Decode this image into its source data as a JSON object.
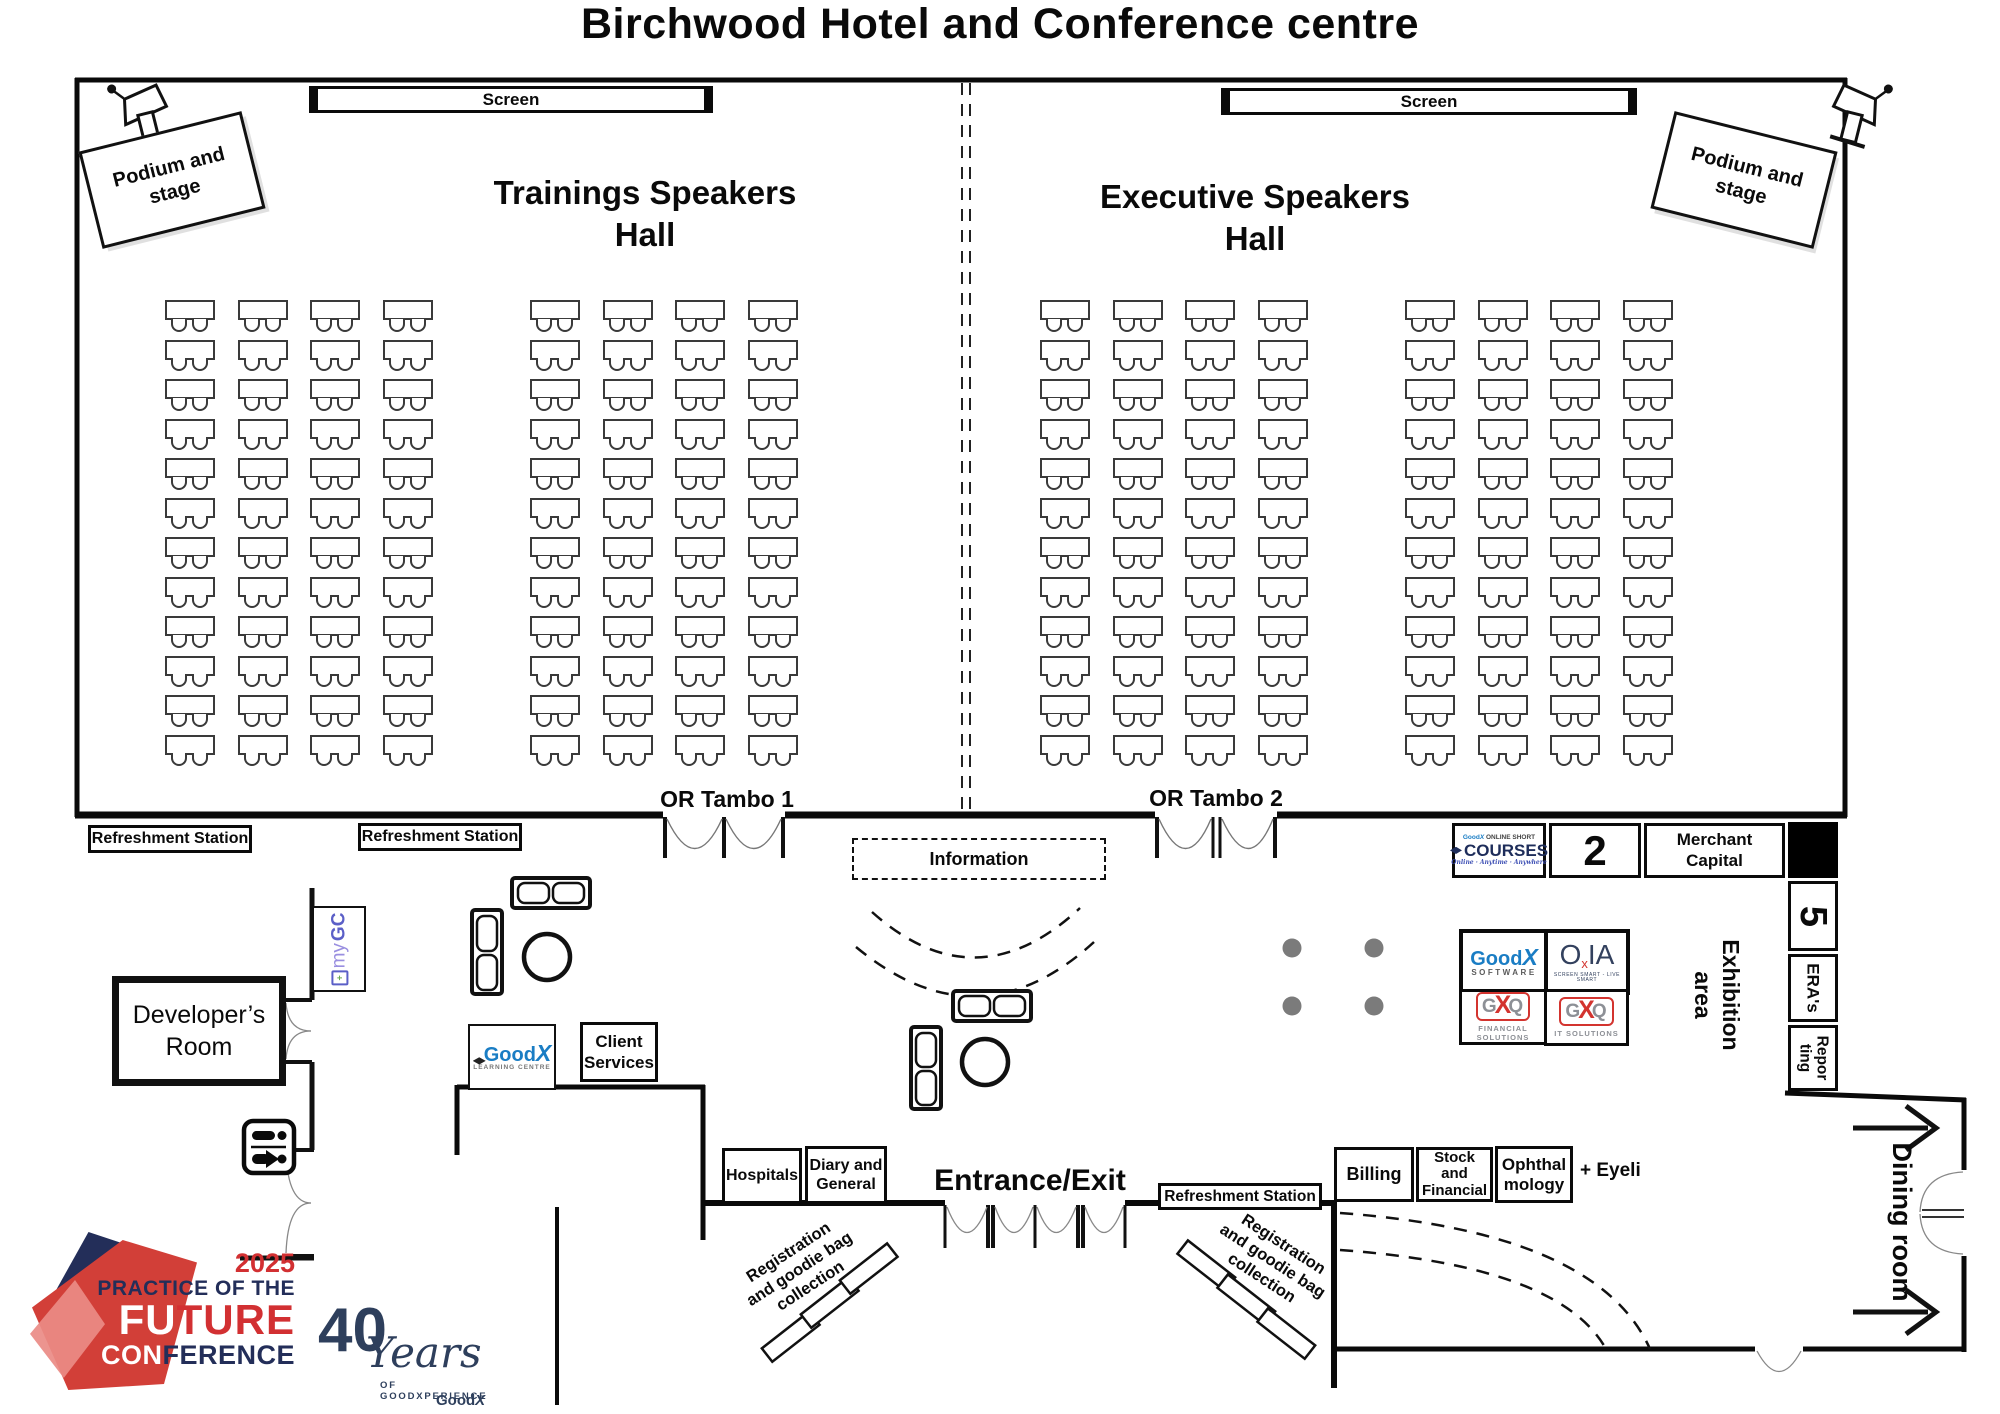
{
  "title": "Birchwood Hotel and Conference centre",
  "halls": {
    "left": {
      "name": "Trainings Speakers\nHall",
      "screen": "Screen",
      "podium": "Podium and\nstage",
      "door": "OR Tambo 1"
    },
    "right": {
      "name": "Executive Speakers\nHall",
      "screen": "Screen",
      "podium": "Podium and\nstage",
      "door": "OR Tambo 2"
    }
  },
  "seating": {
    "rows": 12,
    "cols": 4,
    "col_pitch": 72.5,
    "row_pitch": 39.5,
    "blocks": [
      {
        "x": 165,
        "y": 300
      },
      {
        "x": 530,
        "y": 300
      },
      {
        "x": 1040,
        "y": 300
      },
      {
        "x": 1405,
        "y": 300
      }
    ]
  },
  "concourse": {
    "refreshment_station_a": "Refreshment Station",
    "refreshment_station_b": "Refreshment Station",
    "information": "Information",
    "developers_room": "Developer’s\nRoom",
    "client_services": "Client\nServices",
    "exhibition_area": "Exhibition\narea",
    "mygc": {
      "my": "my",
      "gc": "GC"
    },
    "goodx_learning": {
      "good": "Good",
      "x": "X",
      "sub": "LEARNING CENTRE"
    }
  },
  "stands": {
    "courses": {
      "brand_good": "Good",
      "brand_x": "X",
      "brand_small": "ONLINE SHORT",
      "main": "COURSES",
      "tagline": "Online · Anytime · Anywhere"
    },
    "stand_2": "2",
    "merchant_capital": "Merchant\nCapital",
    "stand_5": "5",
    "eras": "ERA's",
    "reporting": "Repor\nting",
    "goodx_software": {
      "good": "Good",
      "x": "X",
      "sub": "SOFTWARE"
    },
    "oxia": {
      "o": "O",
      "x": "x",
      "ia": "IA",
      "tagline": "SCREEN SMART - LIVE SMART"
    },
    "gxq_financial": {
      "g": "G",
      "x": "X",
      "q": "Q",
      "sub": "FINANCIAL\nSOLUTIONS"
    },
    "gxq_it": {
      "g": "G",
      "x": "X",
      "q": "Q",
      "sub": "IT SOLUTIONS"
    }
  },
  "entrance": {
    "label": "Entrance/Exit",
    "hospitals": "Hospitals",
    "diary_general": "Diary and\nGeneral",
    "billing": "Billing",
    "stock_financial": "Stock\nand\nFinancial",
    "ophthalmology": "Ophthal\nmology",
    "eyeli": "+ Eyeli",
    "registration_left": "Registration\nand goodie bag\ncollection",
    "registration_right": "Registration\nand goodie bag\ncollection",
    "refreshment_station": "Refreshment Station"
  },
  "dining_room": "Dining room",
  "footer": {
    "pof": {
      "year": "2025",
      "line1": "PRACTICE OF THE",
      "fu": "FU",
      "ture": "TURE",
      "con": "CON",
      "ference": "FERENCE"
    },
    "forty": {
      "num": "40",
      "years": "Years",
      "sub": "OF GOODXPERIENCE",
      "brand_good": "Good",
      "brand_x": "X"
    }
  },
  "colors": {
    "wall": "#0a0a0a",
    "seat_stroke": "#3a3a3a",
    "pillar": "#7b7b7b",
    "navy": "#232e59",
    "red": "#d23032",
    "goodx_blue": "#1a7dc4",
    "gxq_red": "#d3342f",
    "gxq_gray": "#8d9096",
    "oxia_navy": "#33415e",
    "mygc_purple": "#9a8fe0",
    "mygc_blue": "#5b5fc7"
  }
}
